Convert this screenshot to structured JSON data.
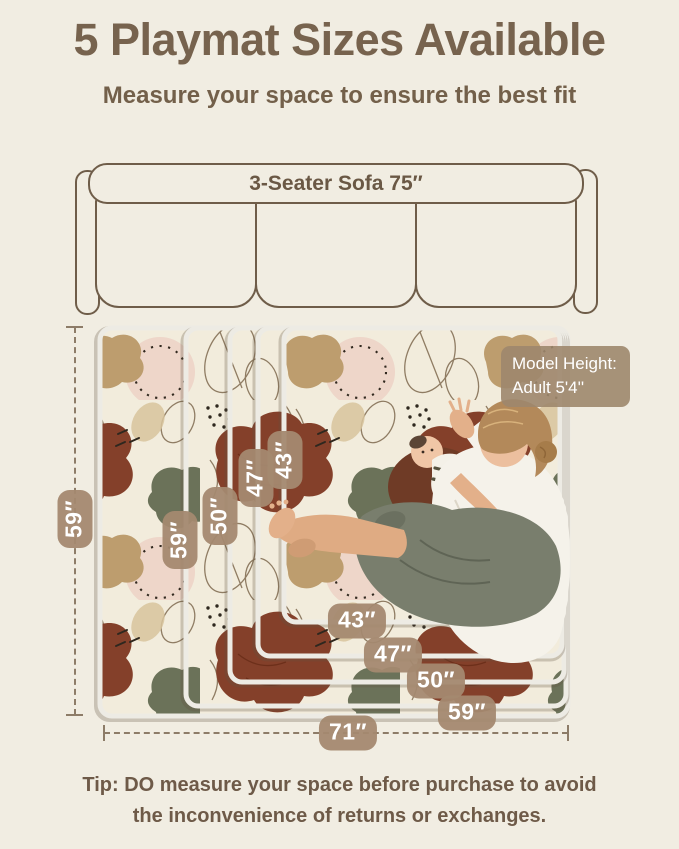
{
  "header": {
    "title": "5 Playmat Sizes Available",
    "subtitle": "Measure your space to ensure the best fit"
  },
  "sofa": {
    "label": "3-Seater Sofa 75″"
  },
  "playmat": {
    "outer_width_label": "71″",
    "outer_height_label": "59″",
    "nested_height_labels": [
      {
        "label": "59″"
      },
      {
        "label": "50″"
      },
      {
        "label": "47″"
      },
      {
        "label": "43″"
      }
    ],
    "nested_width_labels": [
      {
        "label": "43″"
      },
      {
        "label": "47″"
      },
      {
        "label": "50″"
      },
      {
        "label": "59″"
      }
    ]
  },
  "model_badge": {
    "line1": "Model Height:",
    "line2": "Adult  5'4''"
  },
  "tip": {
    "line1": "Tip: DO measure your space before purchase to avoid",
    "line2": "the inconvenience of returns or exchanges."
  },
  "colors": {
    "background": "#f1ede2",
    "heading_brown": "#77634e",
    "badge_tan": "#a48970",
    "sofa_outline": "#6f5d49",
    "mat_rust": "#84402a",
    "mat_olive": "#6b7259",
    "mat_tan": "#bd9d6e",
    "mat_pink": "#eed6c9",
    "mat_cream": "#f2ecdc"
  }
}
